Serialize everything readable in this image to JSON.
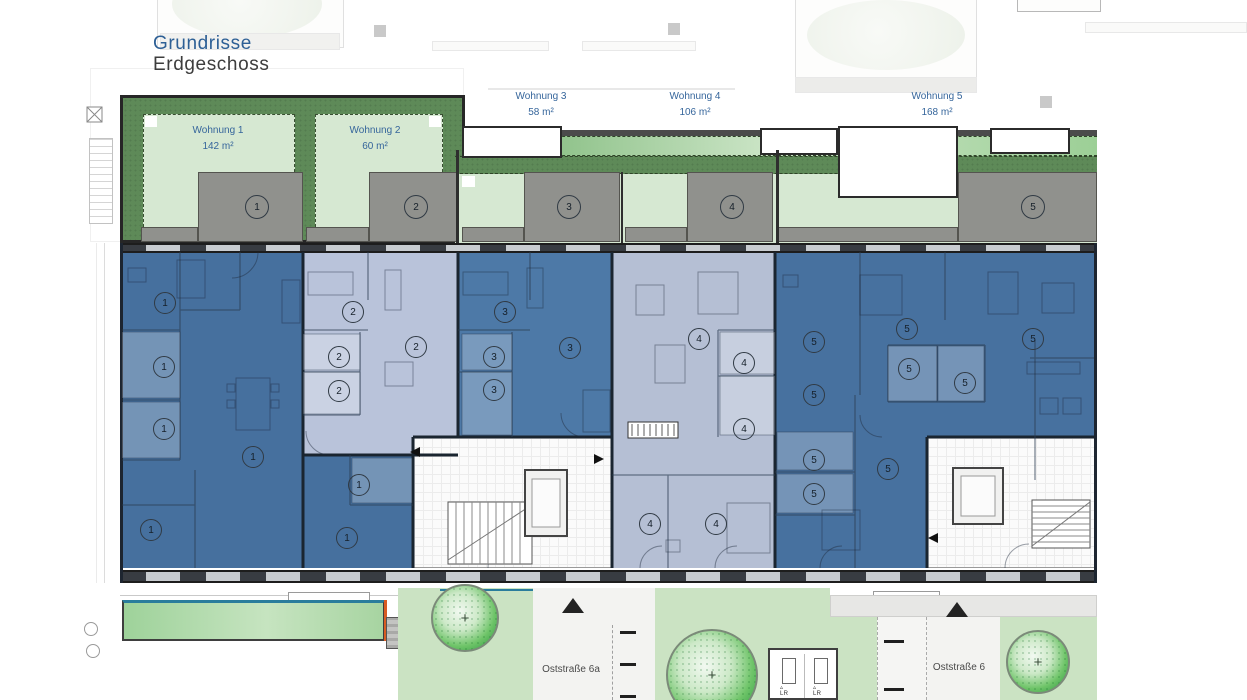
{
  "header": {
    "title": "Grundrisse",
    "subtitle": "Erdgeschoss"
  },
  "apartments": [
    {
      "id": "1",
      "name": "Wohnung 1",
      "area": "142 m²",
      "color": "#46709e",
      "label_x": 218,
      "label_y": 123
    },
    {
      "id": "2",
      "name": "Wohnung 2",
      "area": "60 m²",
      "color": "#b9c3da",
      "label_x": 375,
      "label_y": 123
    },
    {
      "id": "3",
      "name": "Wohnung 3",
      "area": "58 m²",
      "color": "#4d79a7",
      "label_x": 541,
      "label_y": 89
    },
    {
      "id": "4",
      "name": "Wohnung 4",
      "area": "106 m²",
      "color": "#b5bfd4",
      "label_x": 695,
      "label_y": 89
    },
    {
      "id": "5",
      "name": "Wohnung 5",
      "area": "168 m²",
      "color": "#47719f",
      "label_x": 937,
      "label_y": 89
    }
  ],
  "unit_markers": [
    {
      "n": "1",
      "x": 164,
      "y": 302
    },
    {
      "n": "1",
      "x": 163,
      "y": 366
    },
    {
      "n": "1",
      "x": 163,
      "y": 428
    },
    {
      "n": "1",
      "x": 252,
      "y": 456
    },
    {
      "n": "1",
      "x": 358,
      "y": 484
    },
    {
      "n": "1",
      "x": 150,
      "y": 529
    },
    {
      "n": "1",
      "x": 346,
      "y": 537
    },
    {
      "n": "2",
      "x": 352,
      "y": 311
    },
    {
      "n": "2",
      "x": 338,
      "y": 356
    },
    {
      "n": "2",
      "x": 338,
      "y": 390
    },
    {
      "n": "2",
      "x": 415,
      "y": 346
    },
    {
      "n": "3",
      "x": 504,
      "y": 311
    },
    {
      "n": "3",
      "x": 493,
      "y": 356
    },
    {
      "n": "3",
      "x": 493,
      "y": 389
    },
    {
      "n": "3",
      "x": 569,
      "y": 347
    },
    {
      "n": "4",
      "x": 698,
      "y": 338
    },
    {
      "n": "4",
      "x": 743,
      "y": 362
    },
    {
      "n": "4",
      "x": 743,
      "y": 428
    },
    {
      "n": "4",
      "x": 649,
      "y": 523
    },
    {
      "n": "4",
      "x": 715,
      "y": 523
    },
    {
      "n": "5",
      "x": 813,
      "y": 341
    },
    {
      "n": "5",
      "x": 906,
      "y": 328
    },
    {
      "n": "5",
      "x": 1032,
      "y": 338
    },
    {
      "n": "5",
      "x": 908,
      "y": 368
    },
    {
      "n": "5",
      "x": 964,
      "y": 382
    },
    {
      "n": "5",
      "x": 813,
      "y": 394
    },
    {
      "n": "5",
      "x": 813,
      "y": 459
    },
    {
      "n": "5",
      "x": 887,
      "y": 468
    },
    {
      "n": "5",
      "x": 813,
      "y": 493
    }
  ],
  "terrace_markers": [
    {
      "n": "1",
      "x": 256,
      "y": 206
    },
    {
      "n": "2",
      "x": 415,
      "y": 206
    },
    {
      "n": "3",
      "x": 568,
      "y": 206
    },
    {
      "n": "4",
      "x": 731,
      "y": 206
    },
    {
      "n": "5",
      "x": 1032,
      "y": 206
    }
  ],
  "streets": [
    {
      "label": "Oststraße 6a",
      "x": 571,
      "y": 664
    },
    {
      "label": "Oststraße 6",
      "x": 959,
      "y": 662
    }
  ],
  "parking": [
    {
      "label": "LR",
      "x": 780,
      "y": 684
    },
    {
      "label": "LR",
      "x": 813,
      "y": 684
    }
  ],
  "colors": {
    "title_blue": "#2d5f95",
    "subtitle_gray": "#3d3d3d",
    "label_blue": "#35659b",
    "garden_dark_green": "#5e8a58",
    "garden_light_green": "#d6e8d2",
    "lawn_green": "#a7d4a1",
    "landscape_green": "#cbe3c3",
    "terrace_gray": "#90918d",
    "wall_dark": "#1a2530",
    "accent_teal": "#2a7d9c",
    "accent_orange": "#d85c22",
    "tree_green": "#43a64f"
  }
}
